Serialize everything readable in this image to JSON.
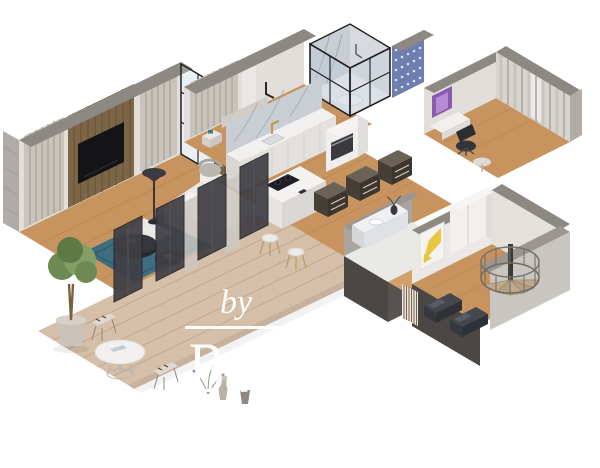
{
  "watermark": {
    "by": "by",
    "brand": "Baerz & Cö",
    "tagline": "LUXURY HOMES"
  },
  "colors": {
    "bg": "#ffffff",
    "watermark": "#ffffff",
    "wallLight": "#e2dfda",
    "wallWhite": "#ebe9e5",
    "wallTop": "#8d8882",
    "concrete": "#b0aba6",
    "darkPanel": "#403f44",
    "woodFloor": "#c7935e",
    "woodPlank": "#b57f4c",
    "deck": "#d5bfa9",
    "rug": "#3e6d80",
    "sofa": "#ebe9e5",
    "woodPanel": "#7d6647",
    "curtain": "#c8c3bb",
    "marble": "#c9cdd4",
    "wallpaper": "#6e7eae",
    "counter": "#f1f0ee",
    "gold": "#c09a4e",
    "yellow": "#e9c63f",
    "purple": "#8a5bb0",
    "treeGreen": "#6c8a52",
    "darkWall": "#4a4744"
  },
  "scene": {
    "kind": "isometric 3D cutaway floor plan render",
    "rooms": [
      "terrace",
      "living-room",
      "kitchen",
      "master-bedroom",
      "glass-shower",
      "office",
      "hallway",
      "bathroom",
      "entrance-hall"
    ]
  }
}
